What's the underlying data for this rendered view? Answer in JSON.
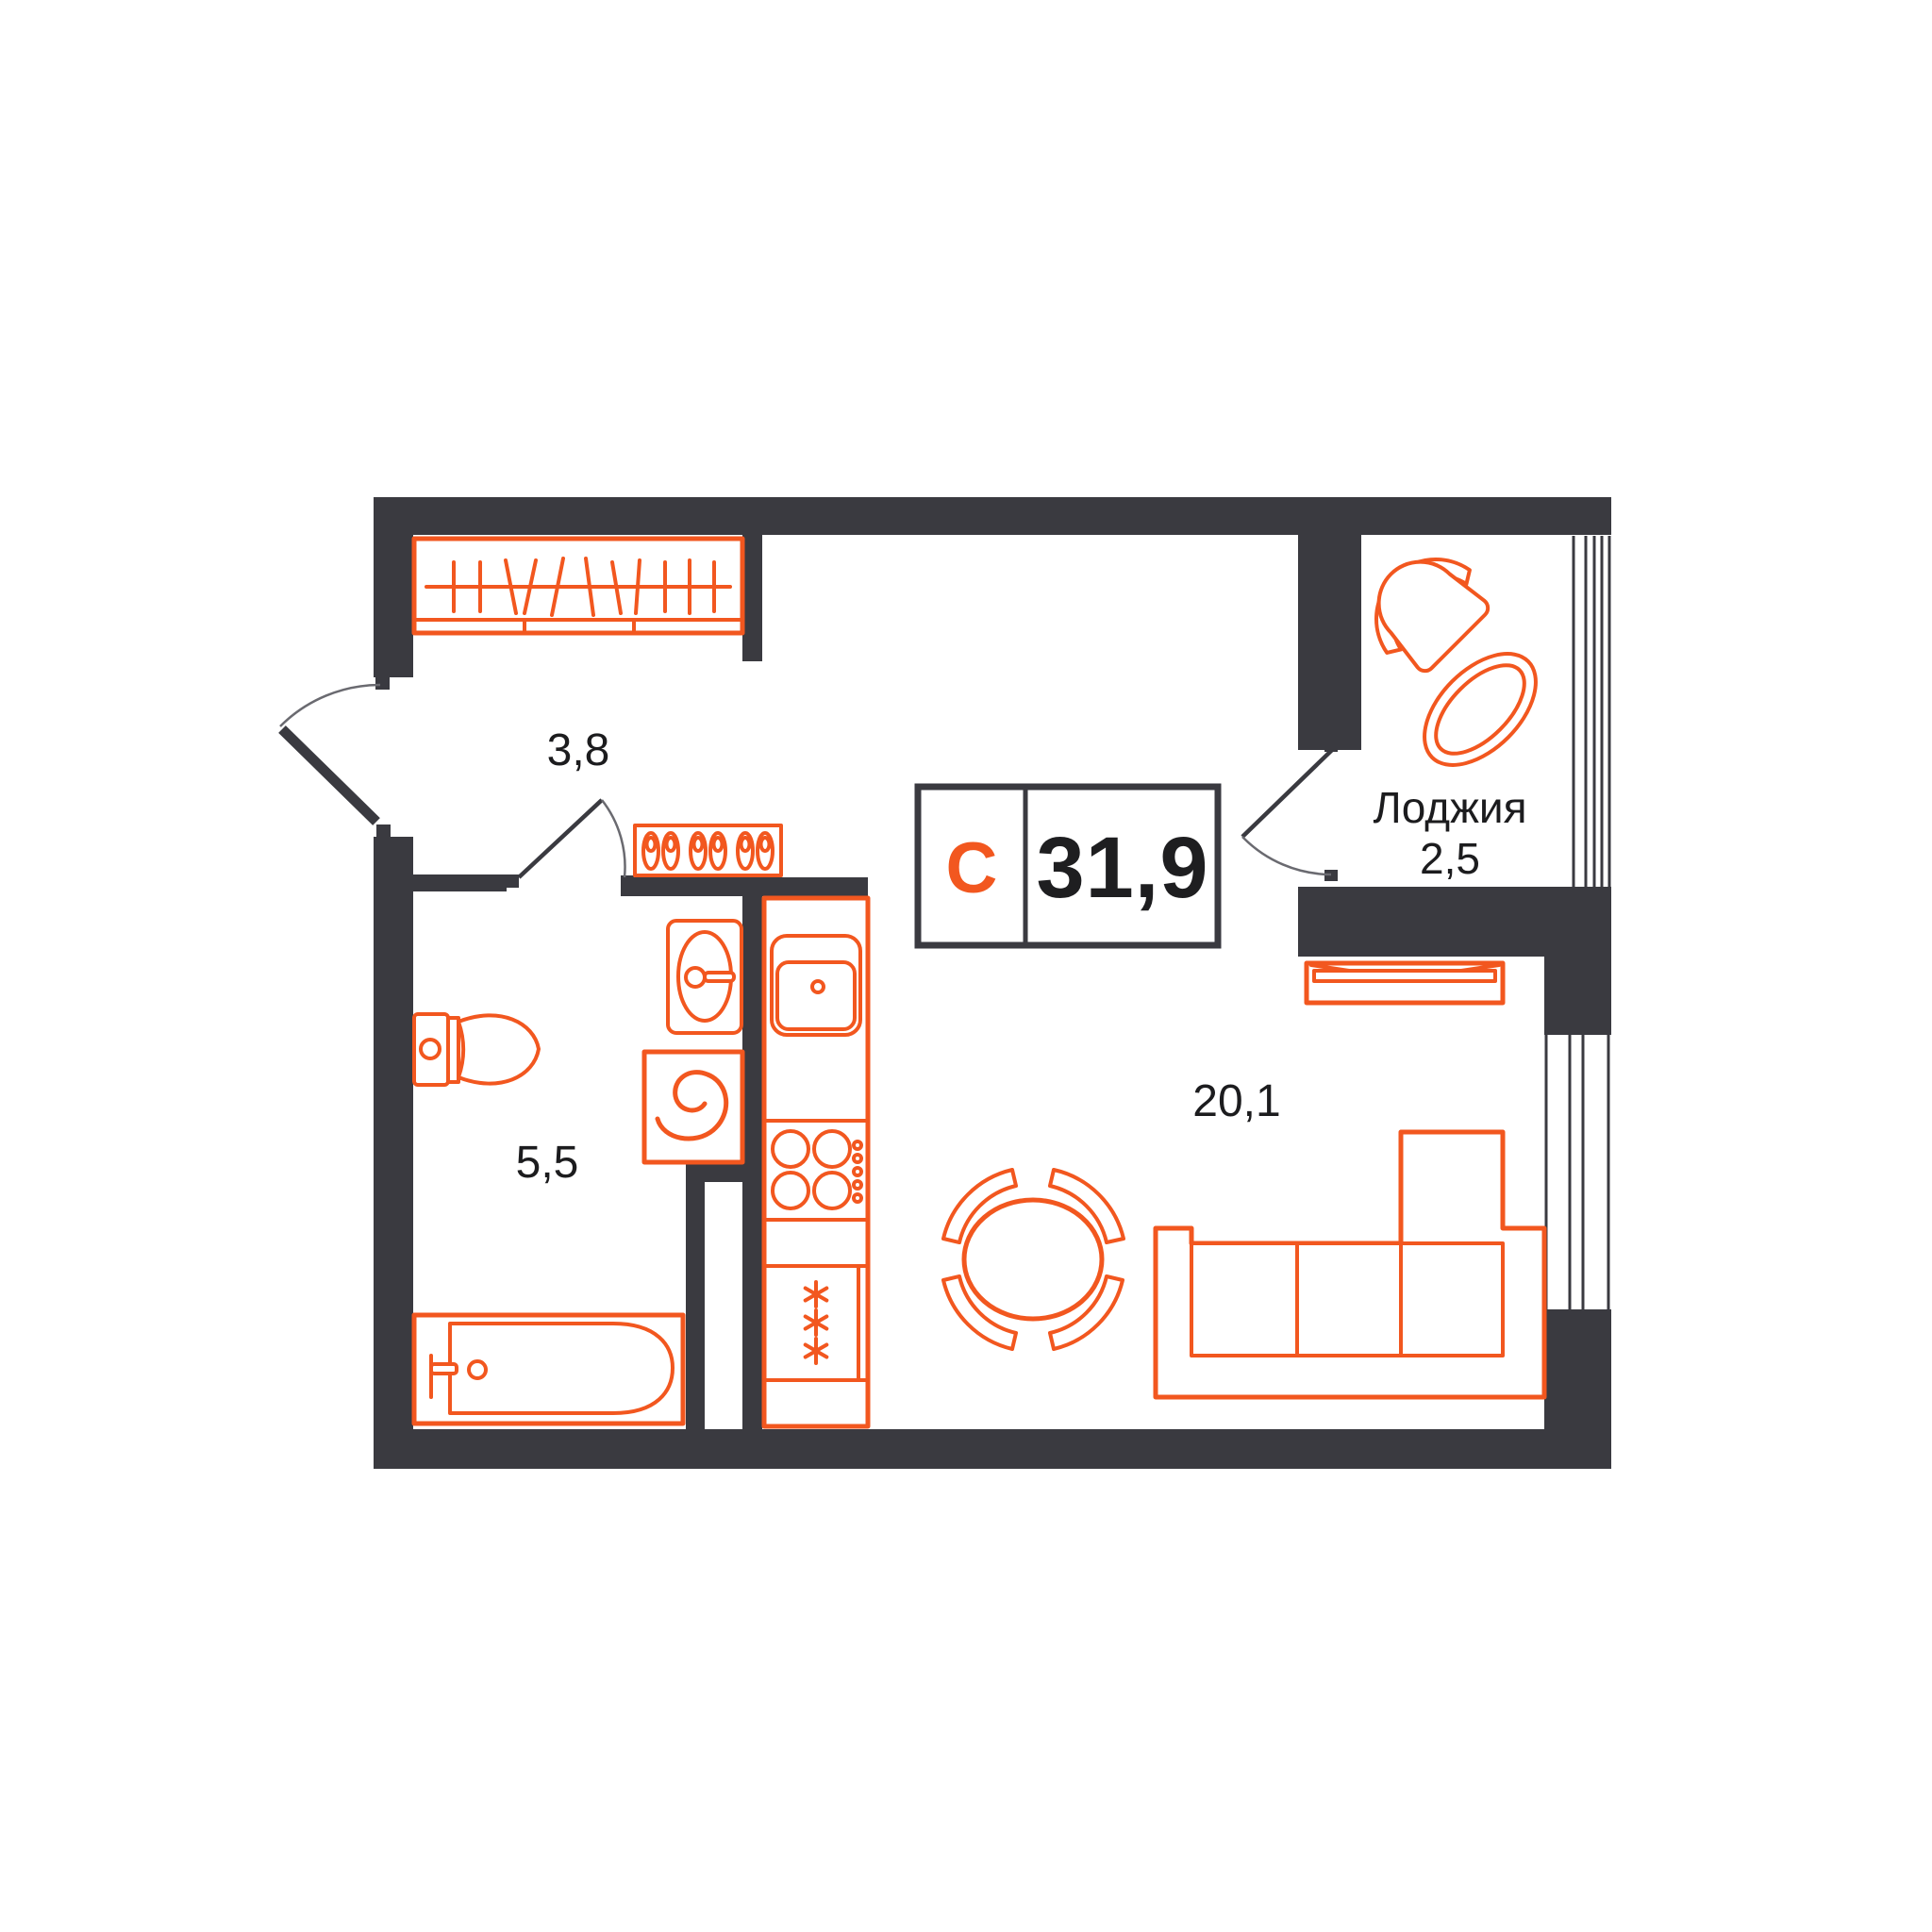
{
  "title": "Studio apartment floor plan",
  "colors": {
    "wall": "#3a3a40",
    "furniture_outline": "#f2571f",
    "text": "#1c1c1e",
    "background": "#ffffff",
    "door_arc": "#6a6a70"
  },
  "area_label": {
    "type_letter": "С",
    "value": "31,9"
  },
  "rooms": {
    "hallway": {
      "area": "3,8"
    },
    "bathroom": {
      "area": "5,5"
    },
    "living": {
      "area": "20,1"
    },
    "loggia": {
      "name": "Лоджия",
      "area": "2,5"
    }
  },
  "furniture_icons": [
    "wardrobe",
    "shoe-rack",
    "toilet",
    "bathroom-sink",
    "washing-machine",
    "bathtub",
    "kitchen-counter",
    "kitchen-sink",
    "stove",
    "fridge",
    "dining-table",
    "dining-chair",
    "sofa",
    "radiator",
    "loggia-chair",
    "loggia-table"
  ]
}
